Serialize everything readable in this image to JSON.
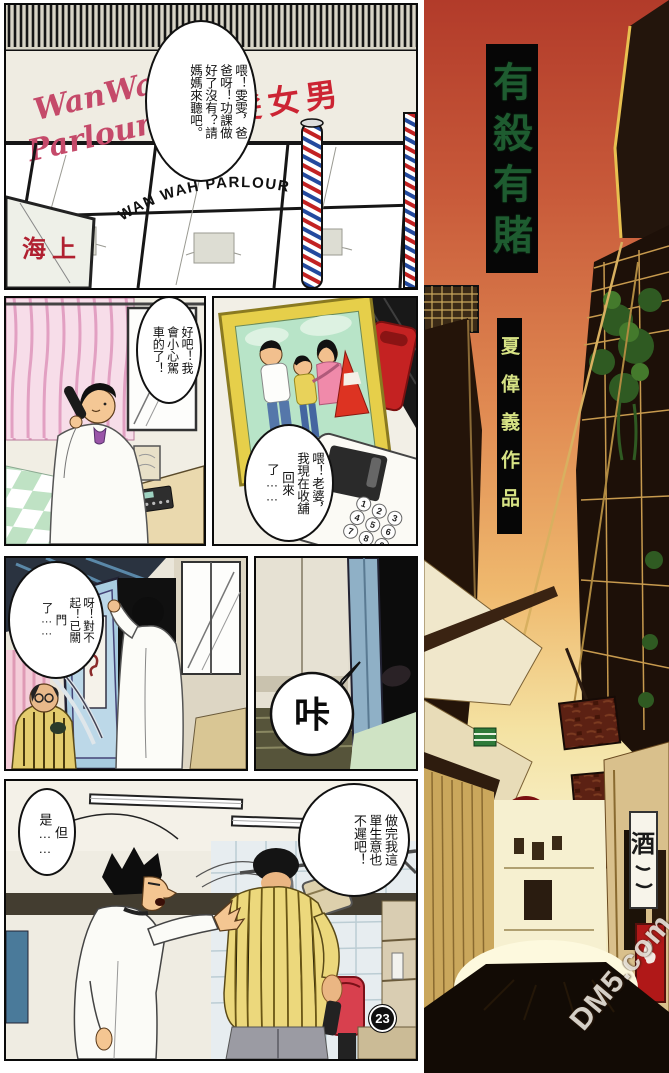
{
  "page": {
    "number": "23",
    "watermark": "DM5.com"
  },
  "cover": {
    "title": "有殺有賭",
    "author": "夏偉義作品",
    "banner": "酒"
  },
  "panel_storefront": {
    "sign_script_top": "WanWah",
    "sign_script_bottom": "Parlour",
    "sign_chinese": "型髮女男",
    "window_arc_text": "WAN WAH PARLOUR",
    "window_chinese": "海上",
    "bubble": "喂！雯雯，爸爸呀！功課做好了沒有？請媽媽來聽吧。"
  },
  "panel_phone_call": {
    "bubble": "好吧！我會小心駕車的了！"
  },
  "panel_photo_phone": {
    "bubble": "喂！老婆，我現在收舖回來了……",
    "keypad": [
      "1",
      "2",
      "3",
      "4",
      "5",
      "6",
      "7",
      "8",
      "9"
    ]
  },
  "panel_shop_door": {
    "bubble": "呀！對不起！已關門了……"
  },
  "panel_door_close": {
    "sfx": "咔"
  },
  "panel_argument": {
    "bubble_left": "但是……",
    "bubble_right": "做完我這單生意也不遲吧！"
  },
  "colors": {
    "sky_top": "#b23b2a",
    "sky_mid": "#e08a52",
    "sky_yellow": "#f8f2cf",
    "title_green": "#1e5c30",
    "author_yellow": "#d6e284",
    "sun_red": "#7b1010",
    "sign_maroon": "#5c2113",
    "barber_red": "#c22222",
    "barber_blue": "#234a9e"
  }
}
